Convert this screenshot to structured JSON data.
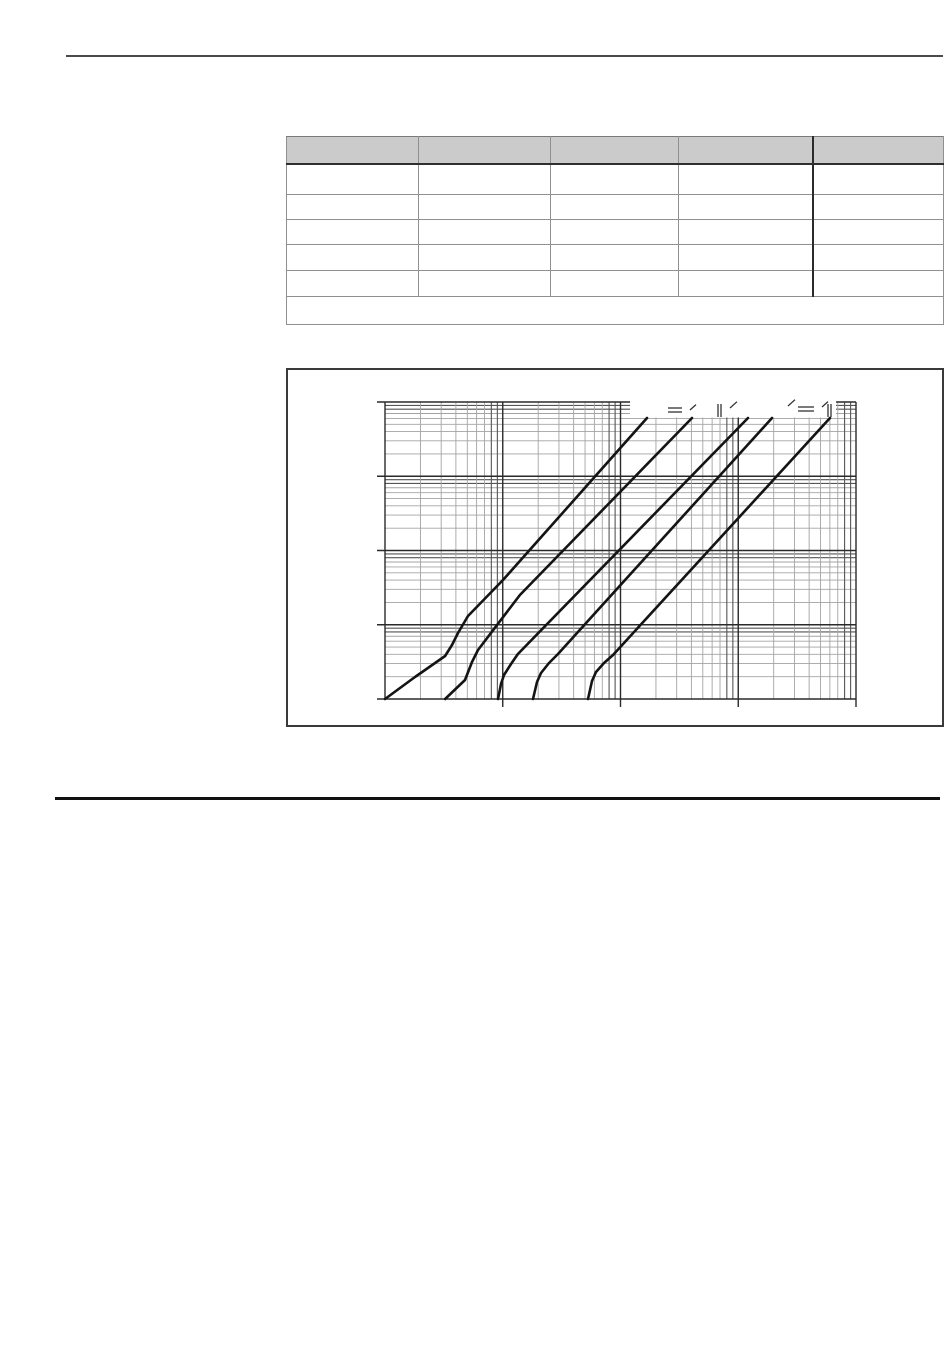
{
  "colors": {
    "rule_top": "#4a4a4a",
    "rule_section": "#111111",
    "table_header_fill": "#cbcbcb",
    "grid_minor": "#a3a3a3",
    "grid_minor_dark": "#555555",
    "grid_major": "#2a2a2a",
    "curve": "#141414",
    "figure_border": "#3a3a3a"
  },
  "table": {
    "columns": [
      "",
      "",
      "",
      "",
      ""
    ],
    "rows": [
      [
        "",
        "",
        "",
        "",
        ""
      ],
      [
        "",
        "",
        "",
        "",
        ""
      ],
      [
        "",
        "",
        "",
        "",
        ""
      ],
      [
        "",
        "",
        "",
        "",
        ""
      ],
      [
        "",
        "",
        "",
        "",
        ""
      ]
    ],
    "footer_note": ""
  },
  "chart_data": {
    "type": "line",
    "scale": "log-log",
    "title": "",
    "xlabel": "",
    "ylabel": "",
    "x_decades": 4,
    "y_decades": 4,
    "grid": "log-log full grid, dark lines near each decade boundary",
    "legend": "none (labels erased in scan)",
    "note": "five monotonically rising characteristic curves; coordinates in log-decade units, x from left axis (0-4 decades), y from bottom axis (0-4 decades)",
    "series": [
      {
        "name": "curve-1",
        "points": [
          [
            0,
            0
          ],
          [
            0.255,
            0.296
          ],
          [
            0.51,
            0.579
          ],
          [
            0.569,
            0.727
          ],
          [
            0.62,
            0.889
          ],
          [
            0.705,
            1.118
          ],
          [
            1.002,
            1.603
          ],
          [
            2.225,
            3.784
          ]
        ]
      },
      {
        "name": "curve-2",
        "points": [
          [
            0.51,
            0
          ],
          [
            0.679,
            0.256
          ],
          [
            0.739,
            0.498
          ],
          [
            0.79,
            0.66
          ],
          [
            1.146,
            1.401
          ],
          [
            2.607,
            3.784
          ]
        ]
      },
      {
        "name": "curve-3",
        "points": [
          [
            0.96,
            0
          ],
          [
            0.985,
            0.202
          ],
          [
            1.011,
            0.323
          ],
          [
            1.07,
            0.471
          ],
          [
            1.129,
            0.606
          ],
          [
            3.083,
            3.784
          ]
        ]
      },
      {
        "name": "curve-4",
        "points": [
          [
            1.257,
            0
          ],
          [
            1.291,
            0.229
          ],
          [
            1.325,
            0.35
          ],
          [
            1.393,
            0.485
          ],
          [
            1.469,
            0.606
          ],
          [
            3.287,
            3.784
          ]
        ]
      },
      {
        "name": "curve-5",
        "points": [
          [
            1.724,
            0
          ],
          [
            1.758,
            0.242
          ],
          [
            1.792,
            0.364
          ],
          [
            1.86,
            0.485
          ],
          [
            1.936,
            0.593
          ],
          [
            3.779,
            3.784
          ]
        ]
      }
    ],
    "erased_label_marks": [
      {
        "kind": "hdash",
        "x": 382,
        "y": 40,
        "len": 14
      },
      {
        "kind": "hdash",
        "x": 382,
        "y": 44,
        "len": 14
      },
      {
        "kind": "vline",
        "x": 432,
        "y": 36,
        "len": 13
      },
      {
        "kind": "vline",
        "x": 435,
        "y": 36,
        "len": 13
      },
      {
        "kind": "hdash",
        "x": 512,
        "y": 39,
        "len": 16
      },
      {
        "kind": "hdash",
        "x": 512,
        "y": 43,
        "len": 16
      },
      {
        "kind": "vline",
        "x": 542,
        "y": 36,
        "len": 13
      },
      {
        "kind": "vline",
        "x": 545,
        "y": 36,
        "len": 13
      },
      {
        "kind": "slash",
        "x": 404,
        "y": 42,
        "len": 6
      },
      {
        "kind": "slash",
        "x": 444,
        "y": 40,
        "len": 7
      },
      {
        "kind": "slash",
        "x": 502,
        "y": 38,
        "len": 7
      },
      {
        "kind": "slash",
        "x": 536,
        "y": 39,
        "len": 6
      }
    ]
  }
}
